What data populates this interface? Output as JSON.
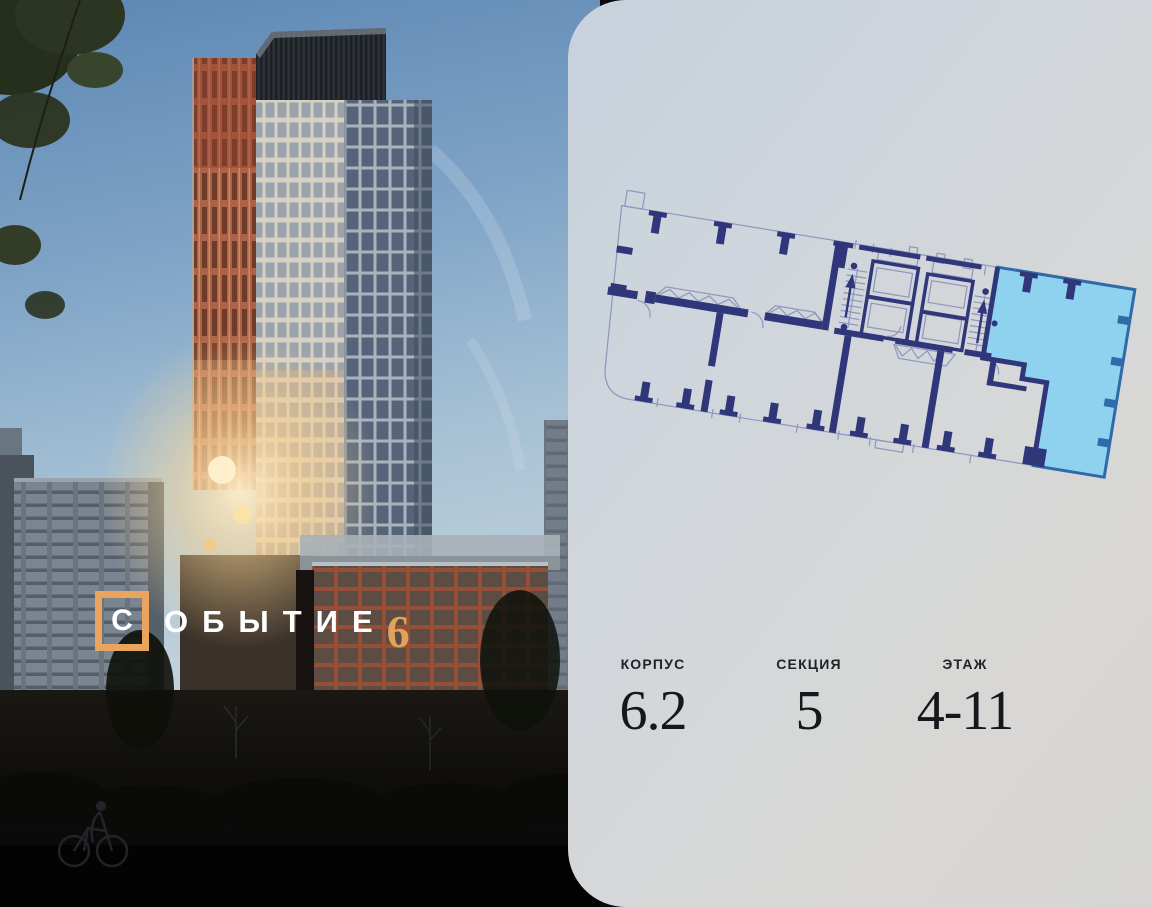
{
  "logo": {
    "first_letter": "С",
    "rest_letters": "ОБЫТИЕ",
    "number": "6",
    "accent_color": "#e9a45e"
  },
  "specs": [
    {
      "label": "КОРПУС",
      "value": "6.2"
    },
    {
      "label": "СЕКЦИЯ",
      "value": "5"
    },
    {
      "label": "ЭТАЖ",
      "value": "4-11"
    }
  ],
  "floor_plan": {
    "wall_color": "#2f3679",
    "outline_color": "#8d96bd",
    "highlight_color": "#8ed2f0",
    "highlight_border": "#2e6ba8"
  },
  "card": {
    "bg_start": "#c7d1dc",
    "bg_end": "#d6d5d4"
  }
}
